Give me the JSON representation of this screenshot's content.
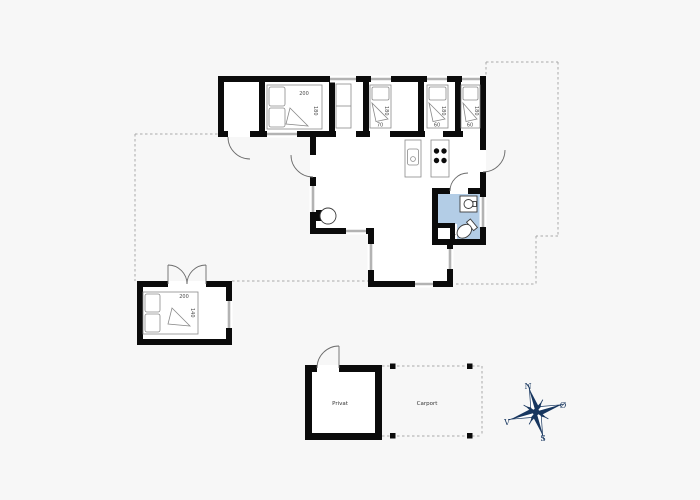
{
  "floor_plan": {
    "labels": {
      "privat": "Privat",
      "carport": "Carport"
    },
    "beds": {
      "master_length": "200",
      "master_width": "180",
      "single1_length": "180",
      "single1_width": "70",
      "single2_length": "180",
      "single2_width": "60",
      "single3_length": "180",
      "single3_width": "60",
      "annex_length": "200",
      "annex_width": "140"
    },
    "compass": {
      "n": "N",
      "e": "Ø",
      "s": "S",
      "v": "V"
    },
    "colors": {
      "wall": "#0b0b0b",
      "window": "#b3b3b3",
      "bathroom_fill": "#b3cde6",
      "compass": "#17365f",
      "background": "#f7f7f7"
    }
  }
}
